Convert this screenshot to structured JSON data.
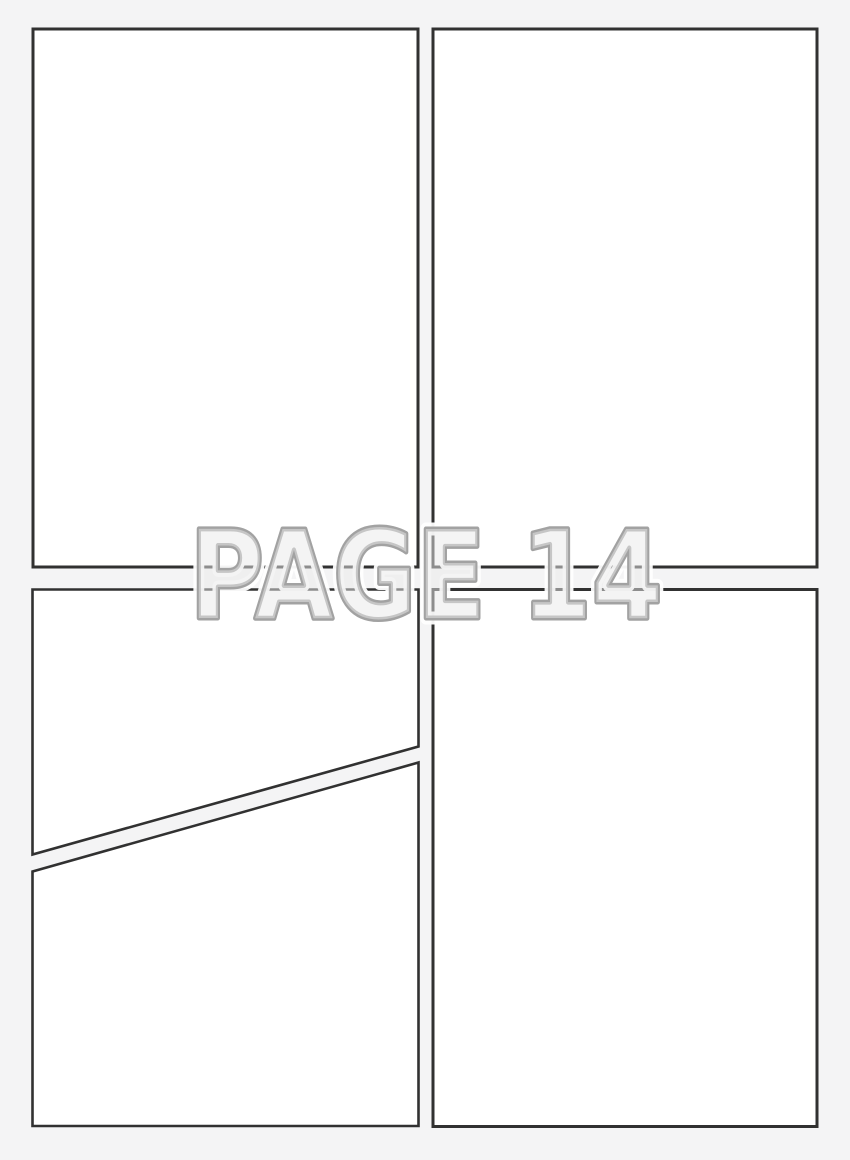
{
  "watermark": {
    "text": "PAGE 14"
  },
  "panels": {
    "count": 5,
    "description_top_left": "empty-panel",
    "description_top_right": "empty-panel",
    "description_bottom_left_upper": "empty-panel-diagonal-top",
    "description_bottom_left_lower": "empty-panel-diagonal-bottom",
    "description_bottom_right": "empty-panel"
  },
  "colors": {
    "background": "#f4f4f5",
    "panel_fill": "#ffffff",
    "panel_border": "#313131",
    "watermark_fill": "#e9e9e9",
    "watermark_stroke": "#a2a2a2",
    "watermark_halo": "#ffffff"
  }
}
